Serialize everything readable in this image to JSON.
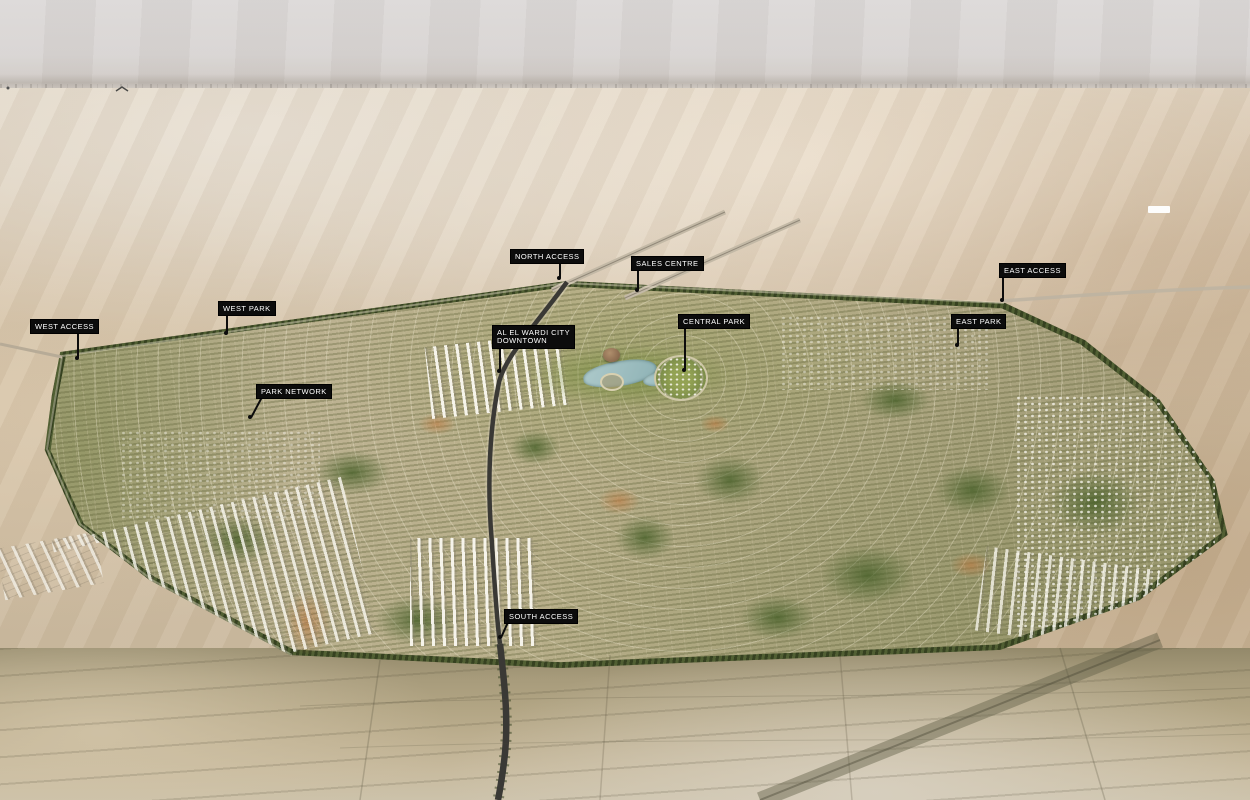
{
  "scene": {
    "type": "aerial-masterplan-render",
    "description": "Bird's-eye 3D render of a large desert master-planned city with black annotation tags marking access points, parks, downtown and sales centre"
  },
  "labels": {
    "west_access": "WEST ACCESS",
    "west_park": "WEST PARK",
    "north_access": "NORTH ACCESS",
    "sales_centre": "SALES CENTRE",
    "downtown_line1": "AL EL WARDI CITY",
    "downtown_line2": "DOWNTOWN",
    "central_park": "CENTRAL PARK",
    "park_network": "PARK NETWORK",
    "east_park": "EAST PARK",
    "east_access": "EAST ACCESS",
    "south_access": "SOUTH ACCESS"
  },
  "colors": {
    "tag_background": "#0c0c0c",
    "tag_text": "#ffffff",
    "sky": "#d7d3d2",
    "desert": "#d2c0a7",
    "city_fabric": "#bab28f",
    "greenery": "#5a6b36",
    "lake": "#a5c4c6",
    "road_dark": "#3a3935"
  }
}
